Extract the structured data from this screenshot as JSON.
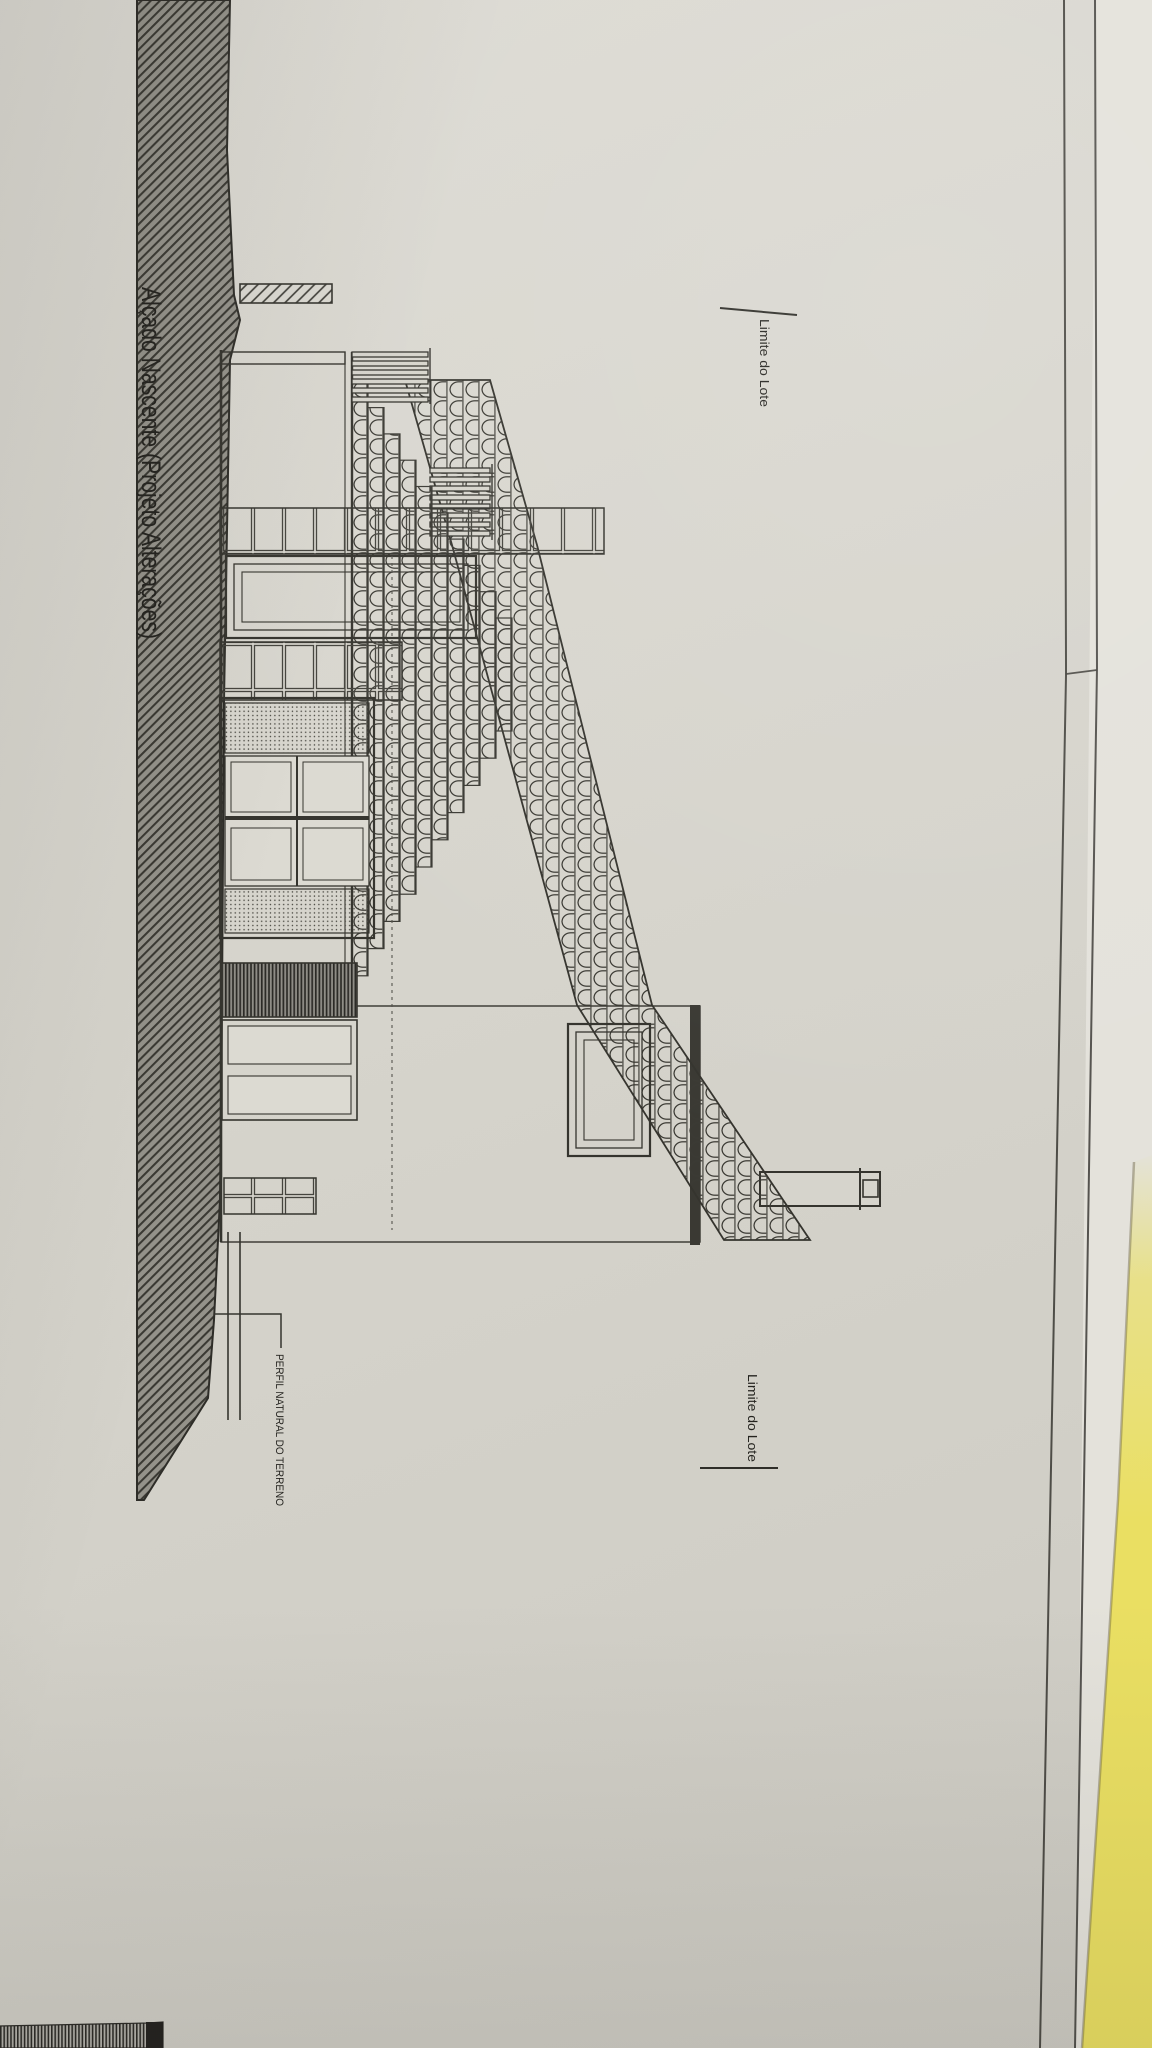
{
  "sheet": {
    "title": "Alçado Nascente (Projeto Alterações)",
    "annotations": {
      "lot_limit_top": "Limite do Lote",
      "lot_limit_bottom": "Limite do Lote",
      "terrain_profile_label": "PERFIL NATURAL DO TERRENO"
    }
  },
  "colors": {
    "paper": "#d6d4cc",
    "ink": "#35342e",
    "terrain_hatch_base": "#94928a",
    "under_sheet": "#e4e2db",
    "folder_yellow": "#e9e06e"
  }
}
